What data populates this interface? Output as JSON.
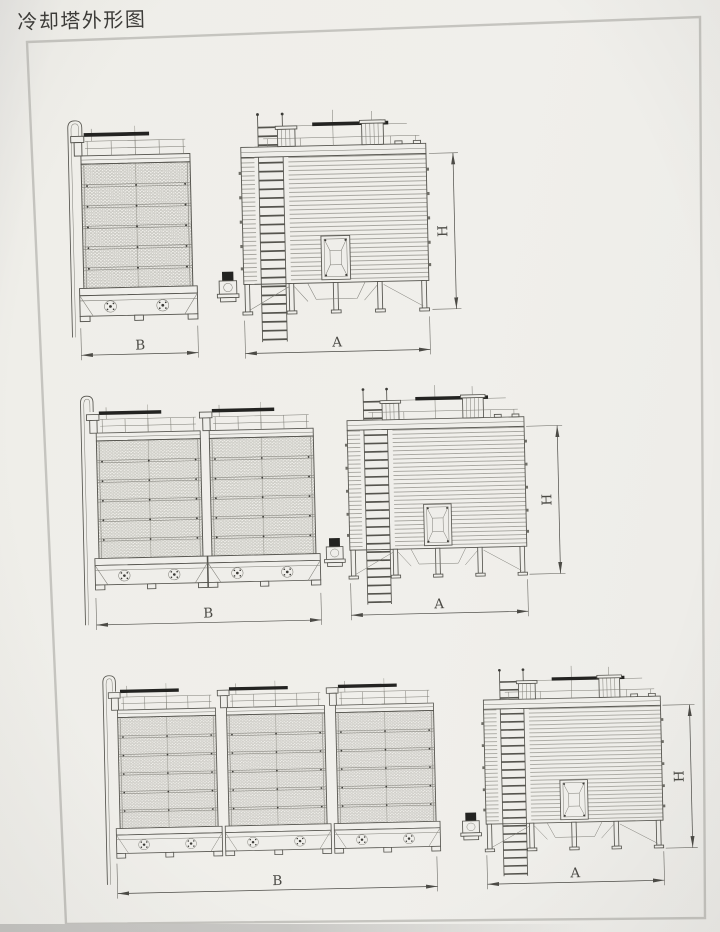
{
  "page": {
    "title": "冷却塔外形图"
  },
  "colors": {
    "paper": "#efeeea",
    "frame_line": "#c5c4bf",
    "drawing_line": "#55544e",
    "detail_line": "#7b7a73",
    "dark_fill": "#232321",
    "dimension_line": "#4c4b46"
  },
  "rows": [
    {
      "name": "single-cell cooling tower",
      "cells": 1,
      "side_width_label": "B",
      "front_width_label": "A",
      "height_label": "H"
    },
    {
      "name": "two-cell cooling tower",
      "cells": 2,
      "side_width_label": "B",
      "front_width_label": "A",
      "height_label": "H"
    },
    {
      "name": "three-cell cooling tower",
      "cells": 3,
      "side_width_label": "B",
      "front_width_label": "A",
      "height_label": "H"
    }
  ]
}
